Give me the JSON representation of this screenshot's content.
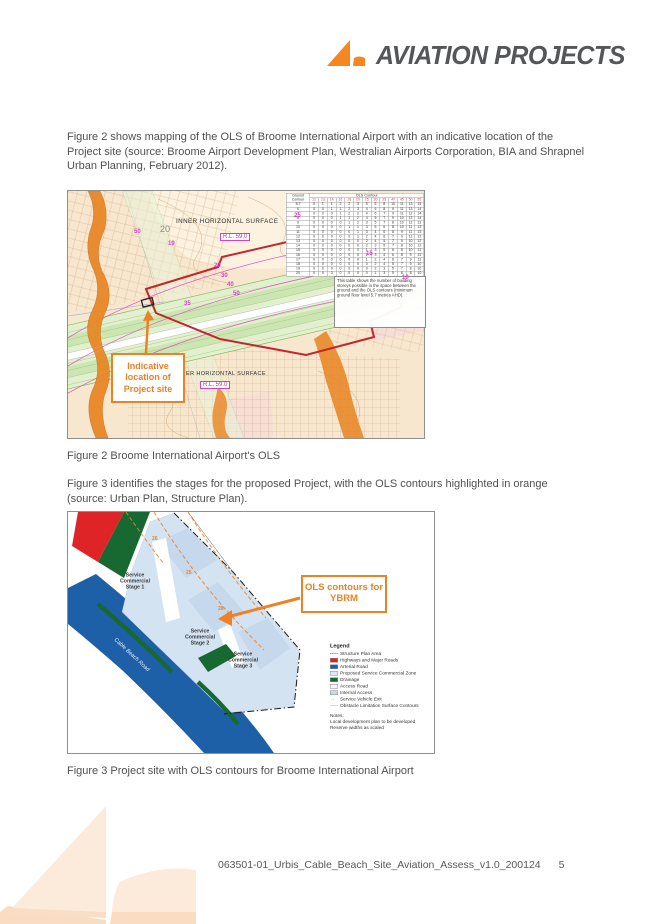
{
  "header": {
    "brand": "AVIATION PROJECTS"
  },
  "paragraphs": {
    "p1": "Figure 2 shows mapping of the OLS of Broome International Airport with an indicative location of the Project site (source: Broome Airport Development Plan, Westralian Airports Corporation, BIA and Shrapnel Urban Planning, February 2012).",
    "p2": "Figure 3 identifies the stages for the proposed Project, with the OLS contours highlighted in orange (source: Urban Plan, Structure Plan)."
  },
  "figure2": {
    "caption": "Figure 2 Broome International Airport's OLS",
    "callout": "Indicative location of Project site",
    "labels": {
      "inner_surface": "INNER HORIZONTAL SURFACE",
      "inner_rl": "R.L. 59.0",
      "outer_surface": "ER HORIZONTAL SURFACE",
      "outer_rl": "R.L. 59.0",
      "big20": "20"
    },
    "note": "This table shows the number of building storeys possible in the space between the ground and the OLS contours (minimum ground floor level 5.7 metres AHD).",
    "table": {
      "corner": "Ground Contour",
      "title": "OLS Contour",
      "columns": [
        "12",
        "13",
        "14",
        "16",
        "18",
        "20",
        "25",
        "30",
        "35",
        "40",
        "45",
        "50",
        "55"
      ],
      "rows": [
        [
          "5.7",
          0,
          1,
          1,
          2,
          2,
          3,
          5,
          6,
          8,
          10,
          11,
          13,
          15
        ],
        [
          "6",
          0,
          0,
          1,
          1,
          2,
          3,
          4,
          6,
          8,
          9,
          11,
          13,
          14
        ],
        [
          "7",
          0,
          0,
          0,
          1,
          2,
          2,
          4,
          6,
          7,
          9,
          11,
          12,
          14
        ],
        [
          "8",
          0,
          0,
          0,
          1,
          1,
          2,
          4,
          5,
          7,
          9,
          10,
          12,
          14
        ],
        [
          "9",
          0,
          0,
          0,
          0,
          1,
          2,
          3,
          5,
          7,
          8,
          10,
          12,
          13
        ],
        [
          "10",
          0,
          0,
          0,
          0,
          1,
          1,
          3,
          5,
          6,
          8,
          10,
          11,
          13
        ],
        [
          "11",
          0,
          0,
          0,
          0,
          0,
          1,
          3,
          4,
          6,
          8,
          9,
          11,
          13
        ],
        [
          "12",
          0,
          0,
          0,
          0,
          0,
          1,
          2,
          4,
          6,
          7,
          9,
          11,
          12
        ],
        [
          "13",
          0,
          0,
          0,
          0,
          0,
          0,
          2,
          4,
          5,
          7,
          9,
          10,
          12
        ],
        [
          "14",
          0,
          0,
          0,
          0,
          0,
          0,
          2,
          3,
          5,
          7,
          8,
          10,
          12
        ],
        [
          "15",
          0,
          0,
          0,
          0,
          0,
          0,
          1,
          3,
          5,
          6,
          8,
          10,
          11
        ],
        [
          "16",
          0,
          0,
          0,
          0,
          0,
          0,
          1,
          3,
          4,
          6,
          8,
          9,
          11
        ],
        [
          "17",
          0,
          0,
          0,
          0,
          0,
          0,
          1,
          2,
          4,
          6,
          7,
          9,
          11
        ],
        [
          "18",
          0,
          0,
          0,
          0,
          0,
          0,
          0,
          2,
          4,
          5,
          7,
          9,
          10
        ],
        [
          "19",
          0,
          0,
          0,
          0,
          0,
          0,
          0,
          2,
          3,
          5,
          7,
          8,
          10
        ],
        [
          "20",
          0,
          0,
          0,
          0,
          0,
          0,
          0,
          1,
          3,
          5,
          6,
          8,
          10
        ]
      ]
    },
    "contour_labels": [
      {
        "t": "50",
        "x": 66,
        "y": 38
      },
      {
        "t": "19",
        "x": 100,
        "y": 50
      },
      {
        "t": "20",
        "x": 146,
        "y": 72
      },
      {
        "t": "30",
        "x": 153,
        "y": 82
      },
      {
        "t": "40",
        "x": 159,
        "y": 91
      },
      {
        "t": "50",
        "x": 165,
        "y": 100
      },
      {
        "t": "25",
        "x": 226,
        "y": 22
      },
      {
        "t": "15",
        "x": 298,
        "y": 60
      },
      {
        "t": "10",
        "x": 334,
        "y": 84
      },
      {
        "t": "35",
        "x": 116,
        "y": 110
      }
    ]
  },
  "figure3": {
    "caption": "Figure 3 Project site with OLS contours for Broome International Airport",
    "callout": "OLS contours for YBRM",
    "road_label": "Cable Beach Road",
    "stages": [
      "Service Commercial Stage 1",
      "Service Commercial Stage 2",
      "Service Commercial Stage 3"
    ],
    "contour_labels": [
      {
        "t": "26",
        "x": 84,
        "y": 24
      },
      {
        "t": "25",
        "x": 118,
        "y": 58
      },
      {
        "t": "28",
        "x": 150,
        "y": 94
      }
    ],
    "legend": {
      "title": "Legend",
      "items": [
        {
          "label": "Structure Plan Area",
          "type": "dashdot",
          "color": "#333333"
        },
        {
          "label": "Highways and Major Roads",
          "type": "swatch",
          "color": "#df2428"
        },
        {
          "label": "Arterial Road",
          "type": "swatch",
          "color": "#1d60a8"
        },
        {
          "label": "Proposed Service Commercial Zone",
          "type": "swatch",
          "color": "#dce9f5"
        },
        {
          "label": "Drainage",
          "type": "swatch",
          "color": "#186831"
        },
        {
          "label": "Access Road",
          "type": "swatch",
          "color": "#f4f7fb"
        },
        {
          "label": "Internal Access",
          "type": "swatch",
          "color": "#c7d9ec"
        },
        {
          "label": "Service Vehicle Exit",
          "type": "arrow",
          "color": "#f08221"
        },
        {
          "label": "Obstacle Limitation Surface Contours",
          "type": "dashed",
          "color": "#f08221"
        }
      ],
      "notes": [
        "Notes:",
        "Local development plan to be developed",
        "Reserve widths as scaled"
      ]
    }
  },
  "footer": {
    "filename": "063501-01_Urbis_Cable_Beach_Site_Aviation_Assess_v1.0_200124",
    "page_number": "5"
  },
  "colors": {
    "accent": "#ef8023",
    "logo_gray": "#54565a",
    "body_text": "#4f5052"
  }
}
